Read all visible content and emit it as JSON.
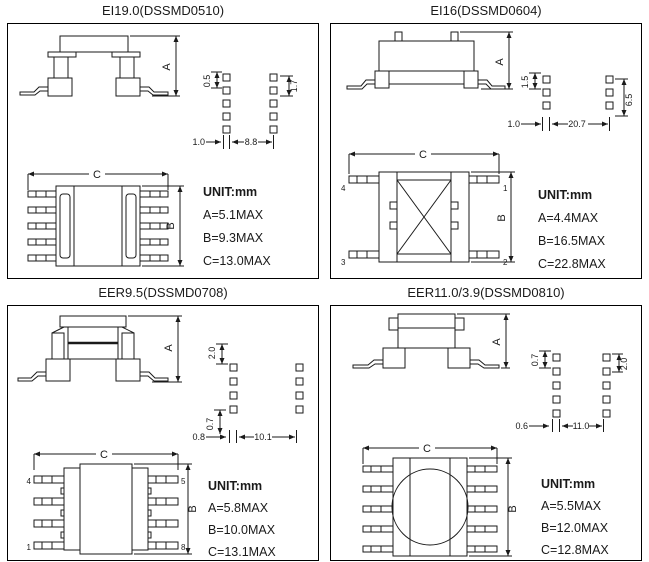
{
  "dim_letters": {
    "a": "A",
    "b": "B",
    "c": "C"
  },
  "panels": [
    {
      "title": "EI19.0(DSSMD0510)",
      "unit": "UNIT:mm",
      "dim_a": "A=5.1MAX",
      "dim_b": "B=9.3MAX",
      "dim_c": "C=13.0MAX",
      "pad": {
        "v_left": "0.5",
        "v_right": "1.7",
        "h_left": "1.0",
        "h_gap": "8.8"
      }
    },
    {
      "title": "EI16(DSSMD0604)",
      "unit": "UNIT:mm",
      "dim_a": "A=4.4MAX",
      "dim_b": "B=16.5MAX",
      "dim_c": "C=22.8MAX",
      "pad": {
        "v_left": "1.5",
        "v_right": "6.5",
        "h_left": "1.0",
        "h_gap": "20.7"
      },
      "pins": {
        "tl": "4",
        "tr": "1",
        "bl": "3",
        "br": "2"
      }
    },
    {
      "title": "EER9.5(DSSMD0708)",
      "unit": "UNIT:mm",
      "dim_a": "A=5.8MAX",
      "dim_b": "B=10.0MAX",
      "dim_c": "C=13.1MAX",
      "pad": {
        "v_top": "2.0",
        "v_left": "0.7",
        "h_left": "0.8",
        "h_gap": "10.1"
      },
      "pins": {
        "tl": "4",
        "tr": "5",
        "bl": "1",
        "br": "8"
      }
    },
    {
      "title": "EER11.0/3.9(DSSMD0810)",
      "unit": "UNIT:mm",
      "dim_a": "A=5.5MAX",
      "dim_b": "B=12.0MAX",
      "dim_c": "C=12.8MAX",
      "pad": {
        "v_left": "0.7",
        "v_right": "2.0",
        "h_left": "0.6",
        "h_gap": "11.0"
      }
    }
  ]
}
